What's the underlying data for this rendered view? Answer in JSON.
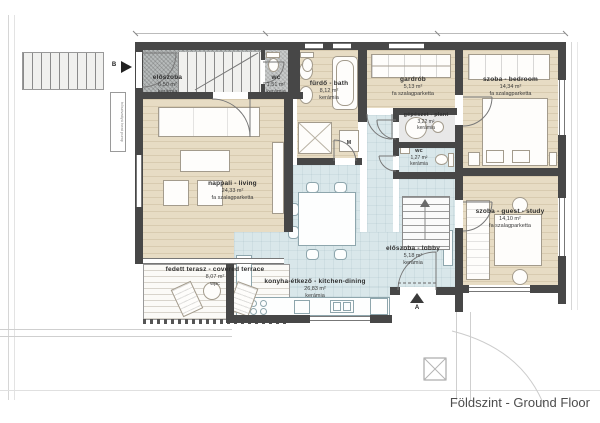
{
  "plan_title": "Földszint - Ground Floor",
  "markers": {
    "entrance_a": "A",
    "stair_b": "B",
    "washing_machine": "M",
    "heat_pump_note": "hőszivattyú heat pump"
  },
  "rooms": {
    "eloszoba": {
      "name": "előszoba",
      "area": "6,50 m²",
      "floor": "kerámia"
    },
    "wc_small": {
      "name": "wc",
      "area": "1,51 m²",
      "floor": "kerámia"
    },
    "bath": {
      "name": "fürdő - bath",
      "area": "8,12 m²",
      "floor": "kerámia"
    },
    "gardrob": {
      "name": "gardrób",
      "area": "5,13 m²",
      "floor": "fa szalagparketta"
    },
    "bedroom": {
      "name": "szoba - bedroom",
      "area": "14,34 m²",
      "floor": "fa szalagparketta"
    },
    "plant": {
      "name": "gépészet - plant",
      "area": "3,22 m²",
      "floor": "kerámia"
    },
    "wc2": {
      "name": "wc",
      "area": "1,27 m²",
      "floor": "kerámia"
    },
    "living": {
      "name": "nappali - living",
      "area": "24,33 m²",
      "floor": "fa szalagparketta"
    },
    "guest": {
      "name": "szoba - guest - study",
      "area": "14,10 m²",
      "floor": "fa szalagparketta"
    },
    "lobby": {
      "name": "előszoba - lobby",
      "area": "5,18 m²",
      "floor": "kerámia"
    },
    "kitchen": {
      "name": "konyha-étkező - kitchen-dining",
      "area": "26,83 m²",
      "floor": "kerámia"
    },
    "terrace": {
      "name": "fedett terasz - covered terrace",
      "area": "8,07 m²",
      "floor": "wpc"
    }
  },
  "colors": {
    "wall": "#474747",
    "wood_floor": "#e7dcc4",
    "ceramic_floor": "#d9e7ea",
    "entry_mat": "#b7bbbb",
    "line": "#8a8a8a"
  }
}
